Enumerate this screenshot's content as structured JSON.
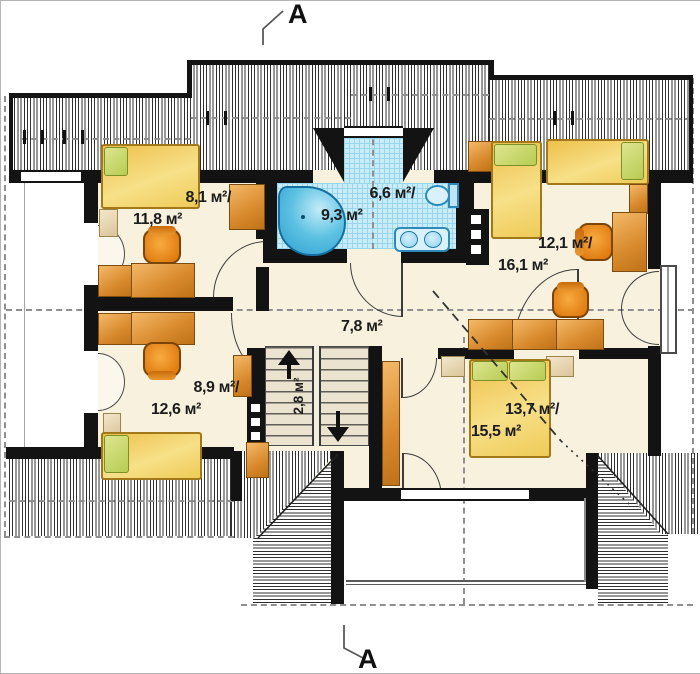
{
  "title": "attic floor plan",
  "section_markers": {
    "top": "A",
    "bottom": "A"
  },
  "rooms": [
    {
      "name": "bedroom-top-left",
      "line1": "8,1 м²/",
      "line2": "11,8 м²"
    },
    {
      "name": "bathroom",
      "line1": "6,6 м²/",
      "line2": "9,3 м²"
    },
    {
      "name": "bedroom-top-right",
      "line1": "12,1 м²/",
      "line2": "16,1 м²"
    },
    {
      "name": "hallway",
      "line1": "7,8 м²",
      "line2": ""
    },
    {
      "name": "bedroom-bottom-left",
      "line1": "8,9 м²/",
      "line2": "12,6 м²"
    },
    {
      "name": "staircase",
      "line1": "2,8 м²",
      "line2": ""
    },
    {
      "name": "master-bedroom",
      "line1": "13,7 м²/",
      "line2": "15,5 м²"
    }
  ],
  "colors": {
    "wall": "#131313",
    "floor": "#f7f1de",
    "bath_tile": "#c9ecf7",
    "tub_blue": "#4fb9dd",
    "furniture_orange": "#e09038",
    "bed_yellow": "#f0c84a",
    "pillow_green": "#c3d467",
    "stair_tread": "#e9e3d0"
  }
}
